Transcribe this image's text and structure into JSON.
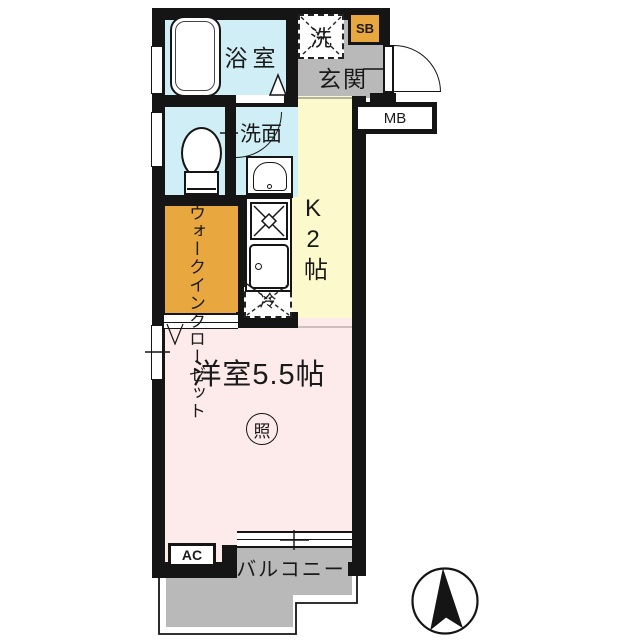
{
  "plan": {
    "bathroom_label": "浴室",
    "laundry_label": "洗",
    "shoebox_label": "SB",
    "entrance_label": "玄関",
    "meterbox_label": "MB",
    "washroom_label": "洗面",
    "kitchen_label": "K2帖",
    "closet_label": "ウォークインクローゼット",
    "main_room_label": "洋室5.5帖",
    "lighting_label": "照",
    "refrigerator_label": "冷",
    "ac_label": "AC",
    "balcony_label": "バルコニー"
  },
  "colors": {
    "wet_area_blue": "#cfeef5",
    "hall_gray": "#b9b9b9",
    "kitchen_yellow": "#fcfacd",
    "room_pink": "#fcebea",
    "accent_orange": "#e8a73f",
    "wall_black": "#151515"
  },
  "compass": {
    "direction": "north-up"
  }
}
